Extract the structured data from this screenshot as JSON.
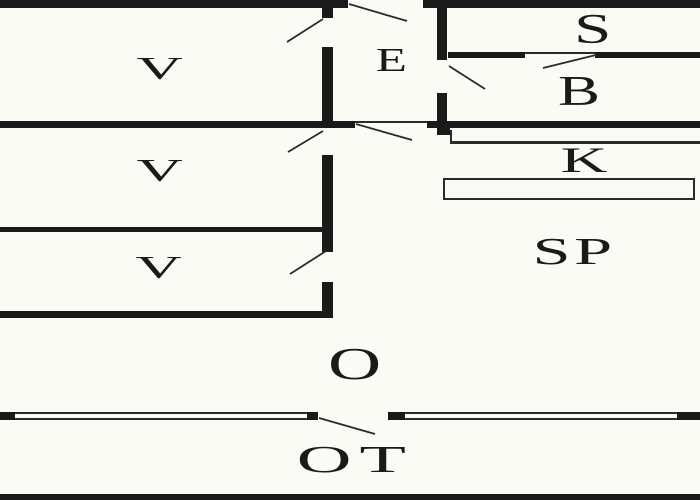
{
  "floor_plan": {
    "title": "floor-plan",
    "colors": {
      "background": "#fbfbf6",
      "wall": "#1a1a1a",
      "thin_line": "#2a2a2a"
    },
    "rooms": [
      {
        "id": "v1",
        "label": "V"
      },
      {
        "id": "v2",
        "label": "V"
      },
      {
        "id": "v3",
        "label": "V"
      },
      {
        "id": "e",
        "label": "E"
      },
      {
        "id": "s",
        "label": "S"
      },
      {
        "id": "b",
        "label": "B"
      },
      {
        "id": "k",
        "label": "K"
      },
      {
        "id": "sp",
        "label": "SP"
      },
      {
        "id": "o",
        "label": "O"
      },
      {
        "id": "ot",
        "label": "OT"
      }
    ]
  }
}
